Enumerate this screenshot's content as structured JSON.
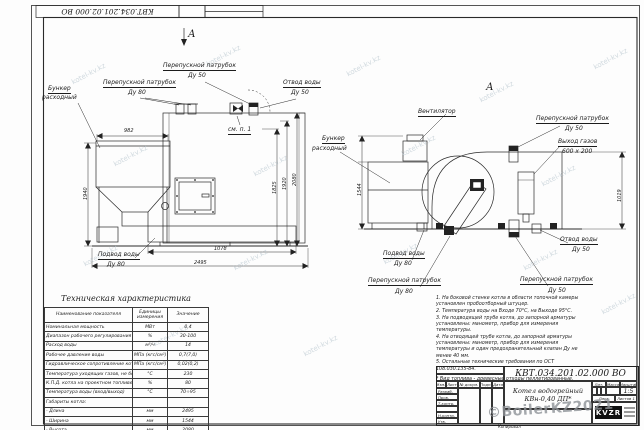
{
  "watermarks": {
    "tile": "kotel-kv.kz",
    "stamp": "©BoilerKZ2021"
  },
  "view_markers": {
    "top": "А",
    "right": "А"
  },
  "left_view": {
    "labels": {
      "bunker_1": "Бункер",
      "bunker_2": "расходный",
      "bypass80": "Перепускной патрубок",
      "bypass80_size": "Ду 80",
      "bypass50": "Перепускной патрубок",
      "bypass50_size": "Ду 50",
      "water_out": "Отвод воды",
      "water_out_size": "Ду 50",
      "see_item": "см. п. 1",
      "water_in": "Подвод воды",
      "water_in_size": "Ду 80"
    },
    "dims": {
      "top_width": "982",
      "left_height": "1940",
      "h1": "1825",
      "h2": "1920",
      "h3": "2080",
      "feeder": "1078",
      "length": "2495"
    }
  },
  "right_view": {
    "labels": {
      "fan": "Вентилятор",
      "bunker_1": "Бункер",
      "bunker_2": "расходный",
      "bypass50_top": "Перепускной патрубок",
      "bypass50_top_size": "Ду 50",
      "gas_out": "Выход газов",
      "gas_out_size": "600 х 200",
      "water_out": "Отвод воды",
      "water_out_size": "Ду 50",
      "bypass50_bot": "Перепускной патрубок",
      "bypass50_bot_size": "Ду 50",
      "bypass80": "Перепускной патрубок",
      "bypass80_size": "Ду 80",
      "water_in": "Подвод воды",
      "water_in_size": "Ду 80"
    },
    "dims": {
      "bunker_height": "1544",
      "outlet_height": "1019"
    }
  },
  "tech_table": {
    "title": "Техническая характеристика",
    "headers": [
      "Наименование показателя",
      "Единицы измерения",
      "Значение"
    ],
    "rows": [
      [
        "Номинальная мощность",
        "МВт",
        "0,4"
      ],
      [
        "Диапазон рабочего регулирования",
        "%",
        "30-100"
      ],
      [
        "Расход воды",
        "м³/ч",
        "14"
      ],
      [
        "Рабочее давление воды",
        "МПа (кгс/см²)",
        "0,7(7,0)"
      ],
      [
        "Гидравлическое сопротивление котла",
        "МПа (кгс/см²)",
        "0,02(0,2)"
      ],
      [
        "Температура уходящих газов, не более",
        "°С",
        "230"
      ],
      [
        "К.П.Д. котла на проектном топливе",
        "%",
        "80"
      ],
      [
        "Температура воды (вход/выход)",
        "°С",
        "70÷95"
      ],
      [
        "Габариты котла:",
        "",
        ""
      ],
      [
        "- Длина",
        "мм",
        "2495"
      ],
      [
        "- Ширина",
        "мм",
        "1544"
      ],
      [
        "- Высота",
        "мм",
        "2080"
      ]
    ]
  },
  "notes": {
    "lines": [
      "1. На боковой стенке котла в области топочной камеры установлен пробоотборный штуцер.",
      "2. Температура воды на Входе 70°С, на Выходе 95°С.",
      "3. На подводящей трубе котла, до запорной арматуры установлены: манометр, прибор для измерения температуры.",
      "4. На отводящей трубе котла, до запорной арматуры установлены: манометр, прибор для измерения температуры и один предохранительный клапан Ду не менее 40 мм.",
      "5. Остальные технические требования по ОСТ 108.030.135-84."
    ],
    "fuel": "* Вид топлива - древесные отходы пеллетированные."
  },
  "title_block": {
    "code": "КВТ.034.201.02.000 ВО",
    "name_1": "Котел водогрейный",
    "name_2": "КВн-0,40 ДП*",
    "cols": [
      "Изм.",
      "Лист",
      "№ докум.",
      "Подп.",
      "Дата"
    ],
    "rows": [
      "Разраб.",
      "Пров.",
      "Т.контр.",
      "",
      "Н.контр.",
      "Утв."
    ],
    "lit": "Лит.",
    "mass": "Масса",
    "scale_label": "Масштаб",
    "scale": "1:5",
    "sheet_label": "Лист",
    "sheets_label": "Листов",
    "sheets": "1",
    "logo": "KVZR",
    "copied": "Копировал"
  }
}
